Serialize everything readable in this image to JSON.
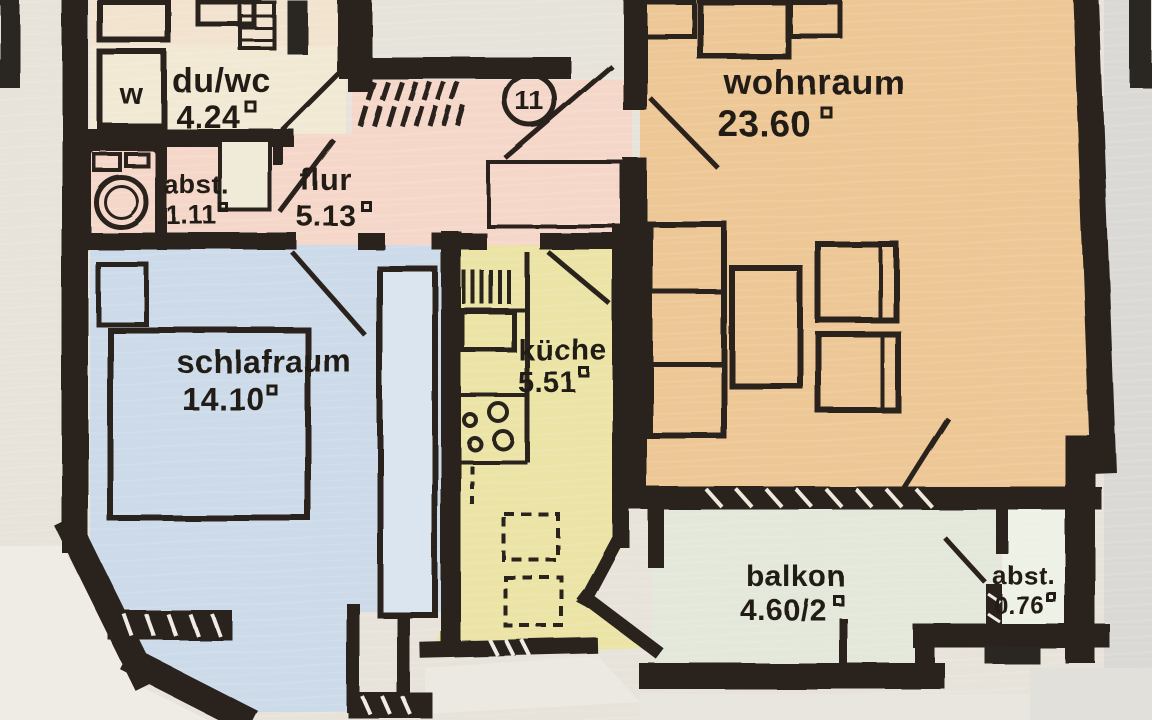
{
  "document": {
    "kind": "scanned hand-colored apartment floor plan",
    "entrance_door_number": "11",
    "washing_machine_label": "w"
  },
  "rooms": [
    {
      "id": "du-wc",
      "label": "du/wc",
      "area": "4.24"
    },
    {
      "id": "abstellraum-1",
      "label": "abst.",
      "area": "1.11"
    },
    {
      "id": "flur",
      "label": "flur",
      "area": "5.13"
    },
    {
      "id": "wohnraum",
      "label": "wohnraum",
      "area": "23.60"
    },
    {
      "id": "schlafraum",
      "label": "schlafraum",
      "area": "14.10"
    },
    {
      "id": "kueche",
      "label": "küche",
      "area": "5.51"
    },
    {
      "id": "balkon",
      "label": "balkon",
      "area": "4.60/2"
    },
    {
      "id": "abstellraum-2",
      "label": "abst.",
      "area": "0.76"
    }
  ],
  "colors": {
    "walls": "#29231c",
    "wohnraum_crayon": "#edc795",
    "schlafraum_crayon": "#ccdae9",
    "kueche_crayon": "#ebe4a6",
    "flur_crayon": "#f5d7ca",
    "balkon_crayon": "#e3e8da",
    "paper": "#e7e3da"
  }
}
